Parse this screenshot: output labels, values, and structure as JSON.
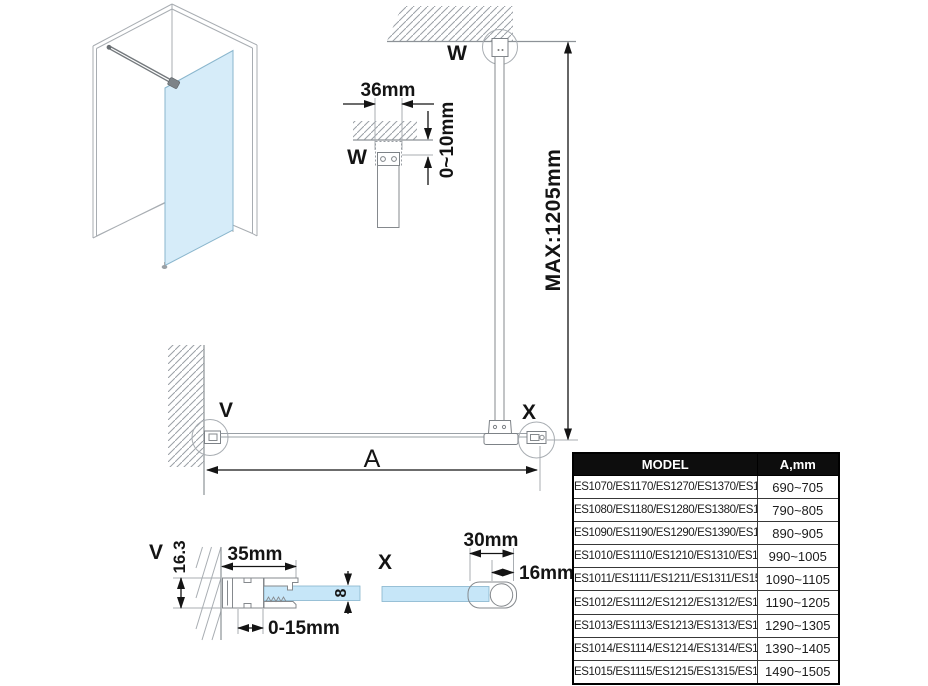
{
  "colors": {
    "glass_iso": "#d6ecf9",
    "glass_section": "#c6e6f8",
    "line_gray": "#a8adb2",
    "dimension": "#141414",
    "table_header_bg": "#0d0d0d",
    "table_header_fg": "#ffffff"
  },
  "diagram": {
    "detail_w": {
      "label": "W",
      "width": "36mm",
      "gap": "0~10mm"
    },
    "elevation": {
      "label": "W",
      "max_height": "MAX:1205mm"
    },
    "plan": {
      "wall_label": "V",
      "bar_label": "X",
      "span": "A"
    },
    "detail_v": {
      "label": "V",
      "profile_height": "16.3",
      "profile_width": "35mm",
      "adjust": "0-15mm",
      "glass_thickness": "8"
    },
    "detail_x": {
      "label": "X",
      "profile_width": "30mm",
      "bar_width": "16mm"
    }
  },
  "table": {
    "headers": {
      "model": "MODEL",
      "a": "A,mm"
    },
    "rows": [
      {
        "model": "ES1070/ES1170/ES1270/ES1370/ES1570",
        "a": "690~705"
      },
      {
        "model": "ES1080/ES1180/ES1280/ES1380/ES1580",
        "a": "790~805"
      },
      {
        "model": "ES1090/ES1190/ES1290/ES1390/ES1590",
        "a": "890~905"
      },
      {
        "model": "ES1010/ES1110/ES1210/ES1310/ES1510",
        "a": "990~1005"
      },
      {
        "model": "ES1011/ES1111/ES1211/ES1311/ES1511",
        "a": "1090~1105"
      },
      {
        "model": "ES1012/ES1112/ES1212/ES1312/ES1512",
        "a": "1190~1205"
      },
      {
        "model": "ES1013/ES1113/ES1213/ES1313/ES1513",
        "a": "1290~1305"
      },
      {
        "model": "ES1014/ES1114/ES1214/ES1314/ES1514",
        "a": "1390~1405"
      },
      {
        "model": "ES1015/ES1115/ES1215/ES1315/ES1515",
        "a": "1490~1505"
      }
    ]
  }
}
